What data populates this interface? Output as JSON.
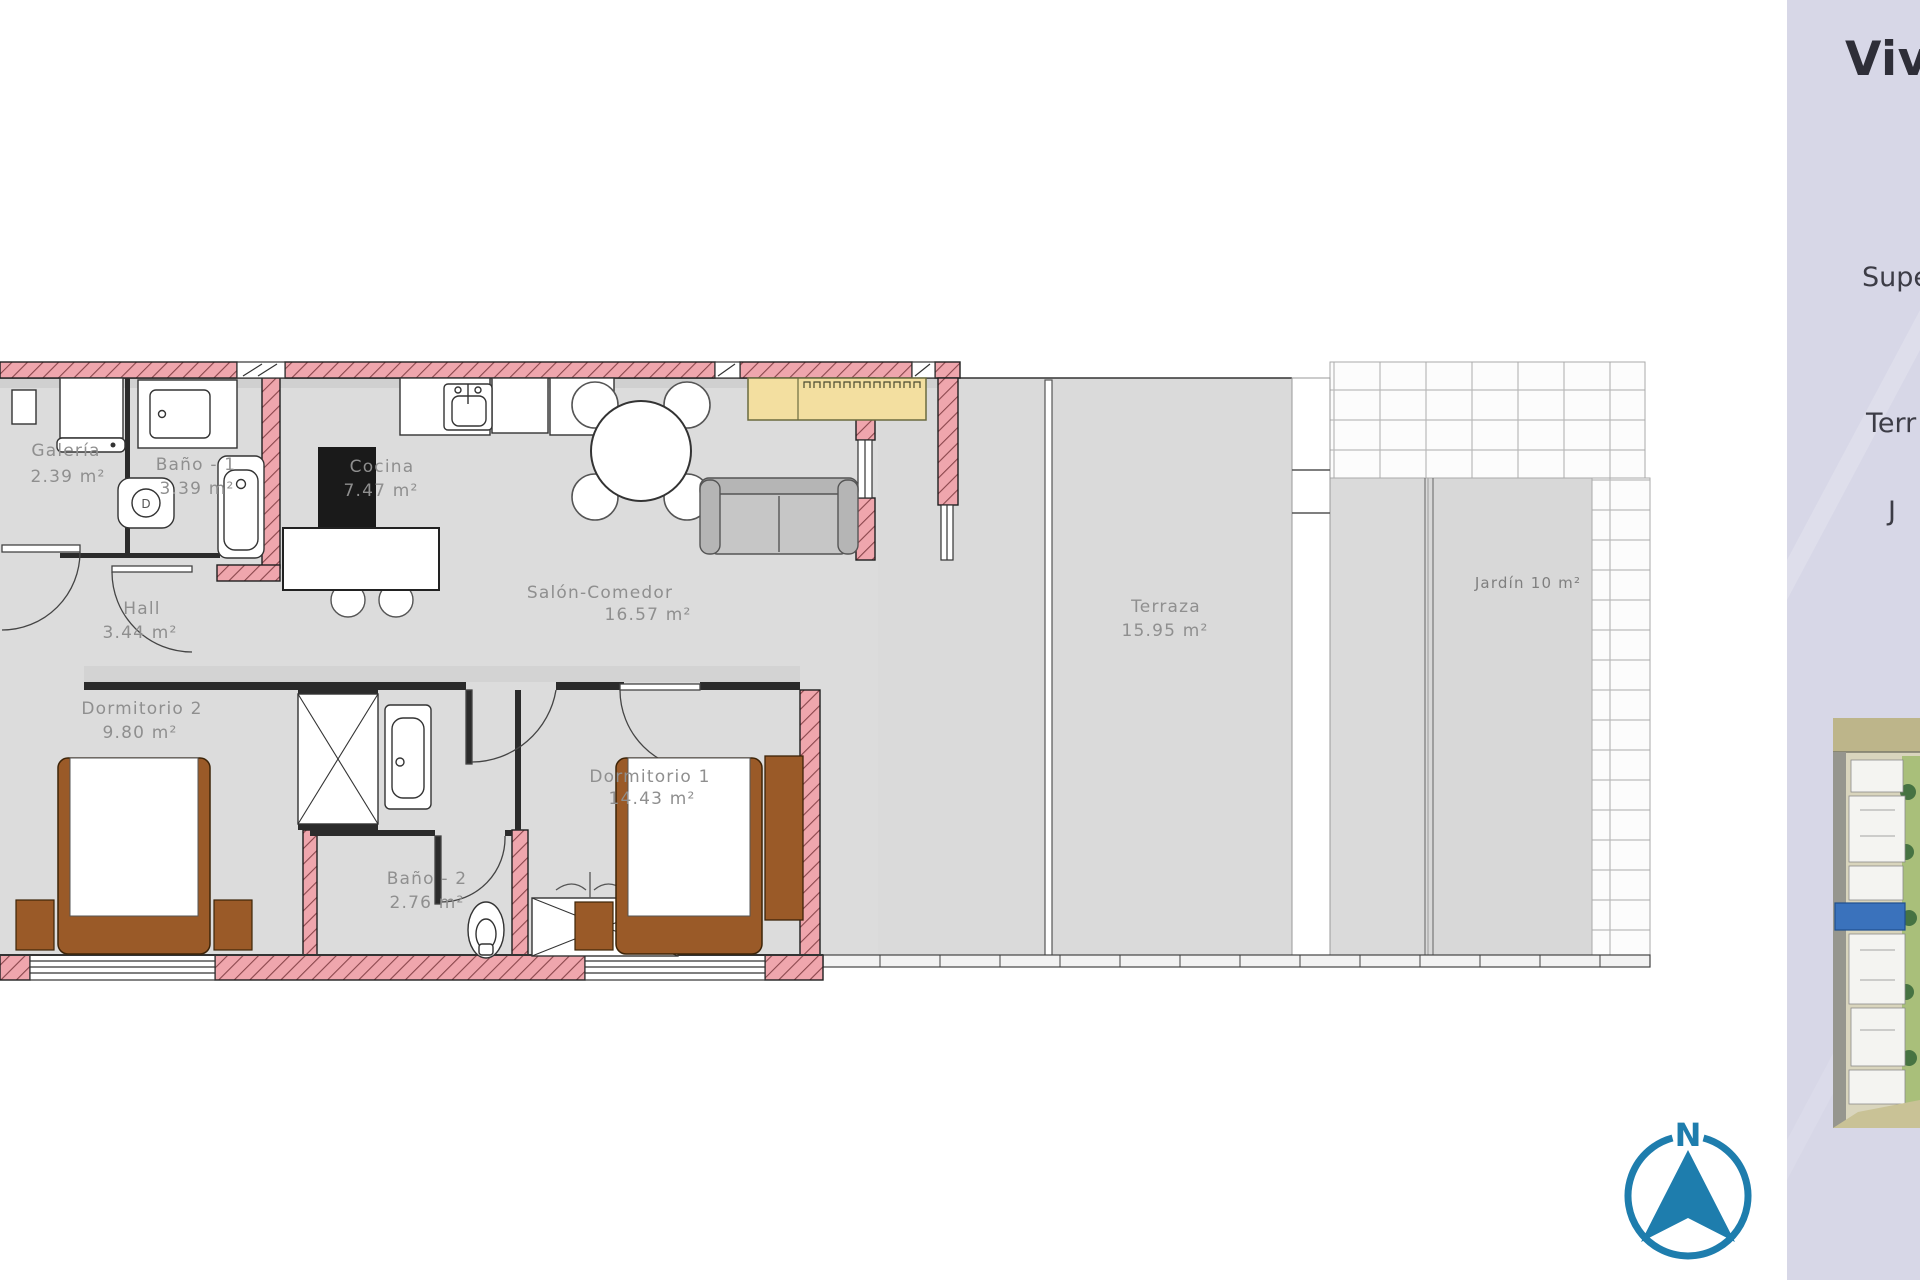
{
  "panel": {
    "background": "#d7d7e7",
    "title_fragment": "Vivie",
    "line_superficie": "Superfic",
    "line_terraza": "Terr",
    "line_jardin": "J"
  },
  "rooms": [
    {
      "name": "Galería",
      "area": "2.39 m²"
    },
    {
      "name": "Baño - 1",
      "area": "3.39 m²"
    },
    {
      "name": "Cocina",
      "area": "7.47 m²"
    },
    {
      "name": "Hall",
      "area": "3.44 m²"
    },
    {
      "name": "Salón-Comedor",
      "area": "16.57 m²"
    },
    {
      "name": "Dormitorio 2",
      "area": "9.80 m²"
    },
    {
      "name": "Dormitorio 1",
      "area": "14.43 m²"
    },
    {
      "name": "Baño - 2",
      "area": "2.76 m²"
    },
    {
      "name": "Terraza",
      "area": "15.95 m²"
    },
    {
      "name": "Jardín 10 m²",
      "area": ""
    }
  ],
  "fixture_marks": {
    "toilet_d": "D"
  },
  "compass": {
    "north_label": "N",
    "color": "#1e7dad"
  },
  "colors": {
    "wall_pink": "#efa6ad",
    "wall_hatch": "#8a464c",
    "floor_gray": "#dcdcdc",
    "floor_shadow": "#cfcfcf",
    "outline_dark": "#2b2b2b",
    "bed_brown": "#9a5a28",
    "sideboard_tan": "#f3dfa0",
    "sofa_gray": "#c2c2c2",
    "compass_blue": "#1e7dad",
    "site_highlight_blue": "#3a72bc",
    "panel_lavender": "#d7d7e7"
  }
}
